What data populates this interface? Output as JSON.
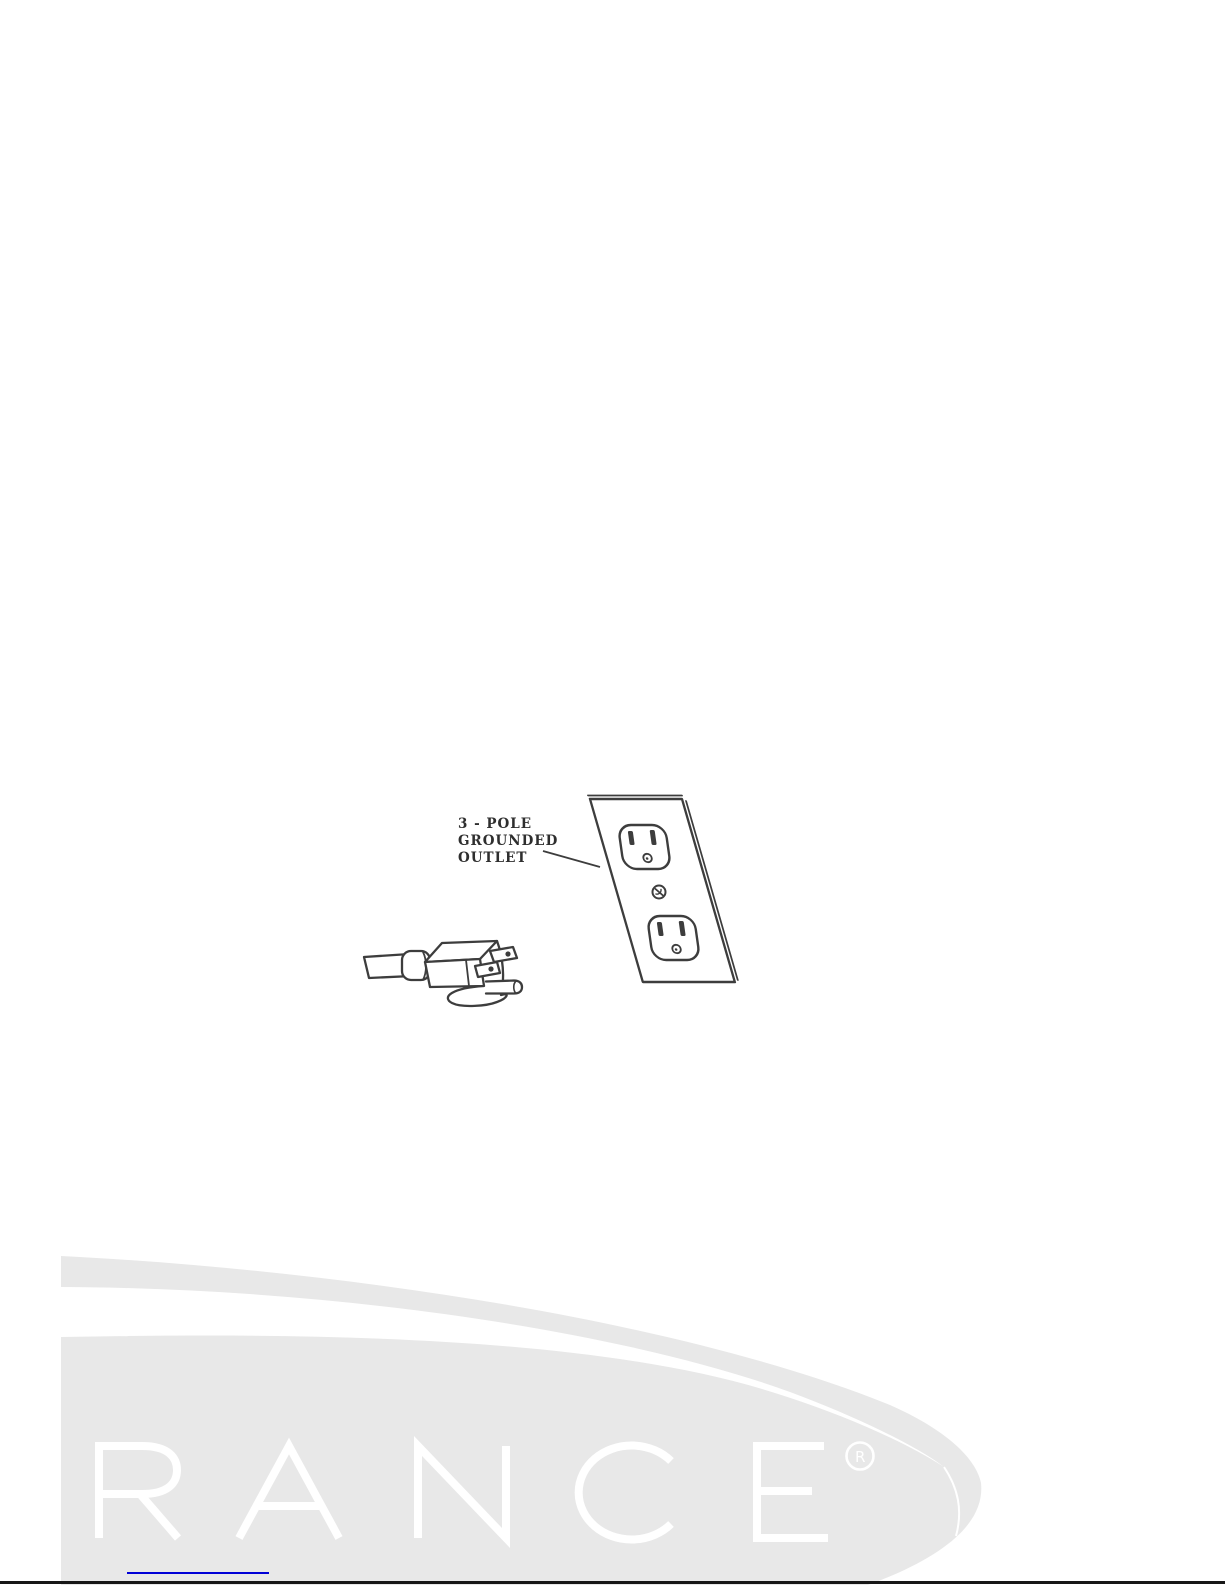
{
  "figure": {
    "label": {
      "line1": "3 - POLE",
      "line2": "GROUNDED",
      "line3": "OUTLET"
    },
    "parts": {
      "plug": "3-prong-power-plug",
      "outlet": "duplex-grounded-wall-outlet"
    },
    "stroke_color": "#3d3d3d"
  },
  "watermark": {
    "text": "RANCE",
    "reg_symbol": "®",
    "reg_letter": "R",
    "color": "#e8e8e8",
    "letter_color": "#ffffff"
  },
  "footer": {
    "link_color": "#0000d6",
    "rule_color": "#171717"
  }
}
